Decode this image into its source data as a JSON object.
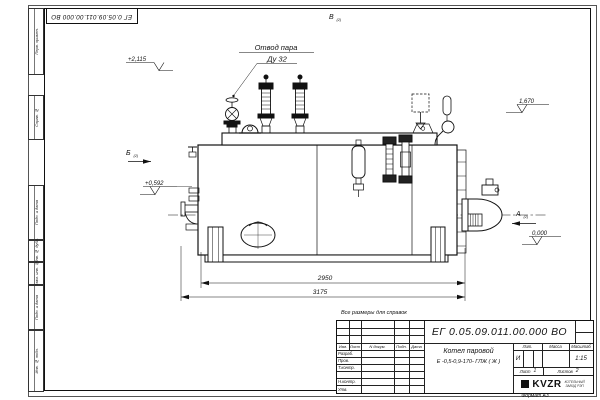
{
  "sheet": {
    "doc_number": "ЕГ 0.05.09.011.00.000 ВО",
    "format_label": "Формат А3",
    "reference_note": "Все размеры для справок"
  },
  "margin_columns": {
    "items": [
      {
        "label": "Перв. примен."
      },
      {
        "label": "Справ. №"
      },
      {
        "label": "Подп. и дата"
      },
      {
        "label": "Инв. № дубл."
      },
      {
        "label": "Взам. инв. №"
      },
      {
        "label": "Подп. и дата"
      },
      {
        "label": "Инв. № подл."
      }
    ]
  },
  "drawing": {
    "callouts": {
      "steam_outlet_line1": "Отвод пара",
      "steam_outlet_line2": "Ду 32"
    },
    "views": {
      "a": "А",
      "b": "Б",
      "v": "В",
      "sheet_ref": "(2)"
    },
    "levels": {
      "top": "+2,115",
      "right_upper": "1,670",
      "left_mid": "+0,592",
      "zero": "0,000"
    },
    "dimensions": {
      "body_length": "2950",
      "overall_length": "3175"
    }
  },
  "title_block": {
    "doc_number": "ЕГ 0.05.09.011.00.000 ВО",
    "columns": {
      "izm": "Изм.",
      "list": "Лист",
      "doc": "N докум.",
      "sign": "Подп.",
      "date": "Дата"
    },
    "rows": {
      "developed": "Разраб.",
      "checked": "Пров.",
      "tcontrol": "Т.контр.",
      "ncontrol": "Н.контр.",
      "approved": "Утв."
    },
    "product_title": "Котел паровой",
    "product_model": "Е -0,5-0,9-170- ГЛЖ ( Ж )",
    "lit_label": "Лит.",
    "lit_value": "И",
    "mass_label": "Масса",
    "scale_label": "Масштаб",
    "scale_value": "1:15",
    "sheet_label": "Лист",
    "sheet_value": "1",
    "sheets_label": "Листов",
    "sheets_value": "2",
    "company": {
      "logo": "KVZR",
      "line1": "КОТЕЛЬНЫЙ",
      "line2": "ЗАВОД РЭП"
    }
  }
}
